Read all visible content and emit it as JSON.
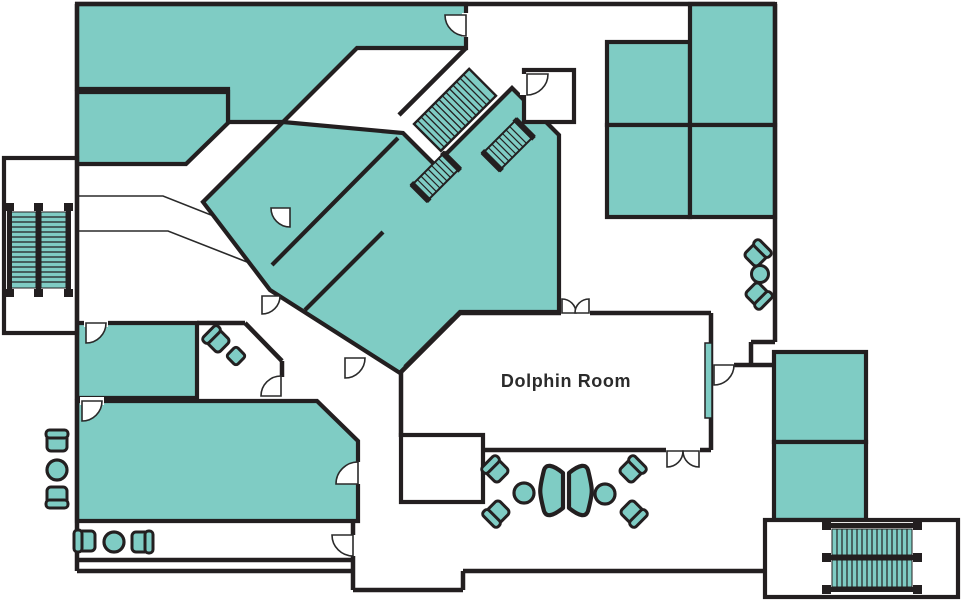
{
  "floor_plan": {
    "title": "Venue floor plan",
    "labels": {
      "dolphin_room": "Dolphin Room"
    },
    "colors": {
      "room_fill": "#7fccc4",
      "wall": "#231f20",
      "thin_line": "#2a2a2a",
      "background": "#ffffff"
    },
    "icons": [
      "stairs-icon",
      "escalator-icon",
      "chair-icon",
      "round-table-icon",
      "side-table-icon",
      "lounge-settee-icon",
      "door-swing-icon"
    ]
  }
}
